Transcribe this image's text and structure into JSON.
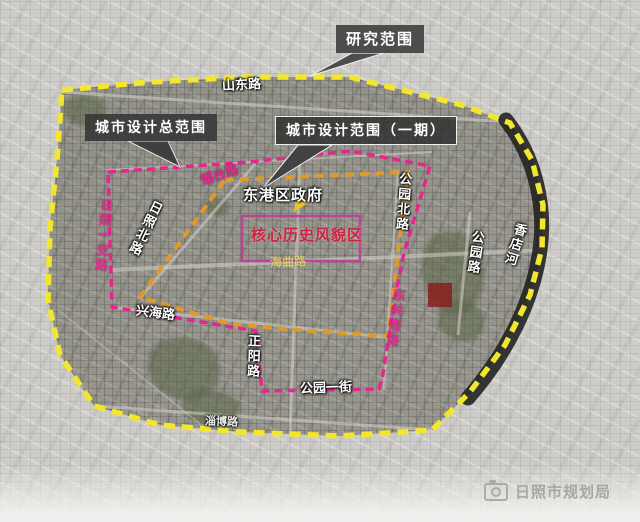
{
  "callouts": {
    "research": {
      "label": "研究范围"
    },
    "total_scope": {
      "label": "城市设计总范围"
    },
    "phase1": {
      "label": "城市设计范围（一期）"
    }
  },
  "landmarks": {
    "district_government": "东港区政府",
    "core_historic_area": "核心历史风貌区"
  },
  "roads": {
    "shandong": "山东路",
    "yantai": "烟台路",
    "rizhao_branch1": "日照一支路",
    "rizhao_north": "日照北路",
    "xinghai": "兴海路",
    "haiqu": "海曲路",
    "gongyuan_north": "公园北路",
    "gongyuan": "公园路",
    "xiangdian_river": "香店河",
    "dongguan_south": "东关南路",
    "zhengyang": "正阳路",
    "gongyuan_first_street": "公园一街",
    "zibo": "淄博路"
  },
  "watermark": {
    "agency": "日照市规划局",
    "icon": "camera-icon"
  },
  "colors": {
    "research_boundary": "#f2e72e",
    "total_scope_boundary": "#e09a2a",
    "phase1_boundary": "#e6268e",
    "core_area_box": "#bb4498",
    "core_area_text": "#cf2140",
    "river": "#1f1f1f",
    "callout_background": "#3a3a3a"
  }
}
